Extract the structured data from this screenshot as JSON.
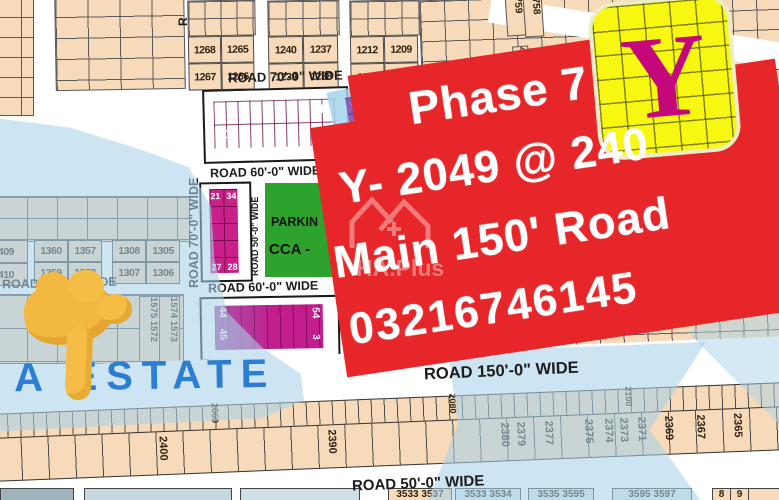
{
  "banner": {
    "bg": "#e62628",
    "lines": [
      "Phase 7",
      "Y- 2049 @ 240",
      "Main 150' Road",
      "03216746145"
    ]
  },
  "y_marker": {
    "letter": "Y"
  },
  "watermark": {
    "text": "HA.Plus"
  },
  "estate": {
    "label": "A ESTATE"
  },
  "roads": {
    "top70": "ROAD 70'-0\" WIDE",
    "mid60": "ROAD 60'-0\" WIDE",
    "low60": "ROAD 60'-0\" WIDE",
    "vert50": "ROAD 50'-0\" WIDE",
    "vert70": "ROAD 70'-0\" WIDE",
    "vert_top_partial": "R",
    "left_partial_road": "ROAD",
    "left_partial_wide": "WIDE",
    "main150": "ROAD 150'-0\" WIDE",
    "bottom50": "ROAD 50'-0\" WIDE"
  },
  "top_blocks": [
    [
      "1268",
      "1265",
      "1267",
      "1266"
    ],
    [
      "1240",
      "1237",
      "1239",
      "1238"
    ],
    [
      "1212",
      "1209",
      "1211",
      "1210"
    ]
  ],
  "mid_blocks": [
    [
      "1360",
      "1357",
      "1359",
      "1358"
    ],
    [
      "1308",
      "1305",
      "1307",
      "1306"
    ]
  ],
  "edge_clipped": [
    "409",
    "410"
  ],
  "pink1": {
    "tl": "1",
    "tr": "10",
    "bl": "20",
    "br": "11"
  },
  "pink2": {
    "cells": [
      "21",
      "34",
      "27",
      "28"
    ]
  },
  "pink3": {
    "lt": "44",
    "lb": "45",
    "rt": "54",
    "rb": "3"
  },
  "purple77": "77 78",
  "parking": [
    "PARKIN",
    "CCA -"
  ],
  "vert_cols": [
    "1575 1572",
    "1574 1573"
  ],
  "corner": {
    "a": "759",
    "b": "758",
    "c": "4",
    "d": "5"
  },
  "strip1": [
    "2060",
    "2080",
    "2100"
  ],
  "strip2": [
    "2410",
    "2400",
    "2390",
    "2380",
    "2379",
    "2377",
    "2375",
    "2374",
    "2373",
    "2371",
    "2369",
    "2367",
    "2365"
  ],
  "bottom_row": [
    "3533 3537",
    "3533 3534",
    "3535 3595",
    "3595 3597",
    "8",
    "9"
  ]
}
